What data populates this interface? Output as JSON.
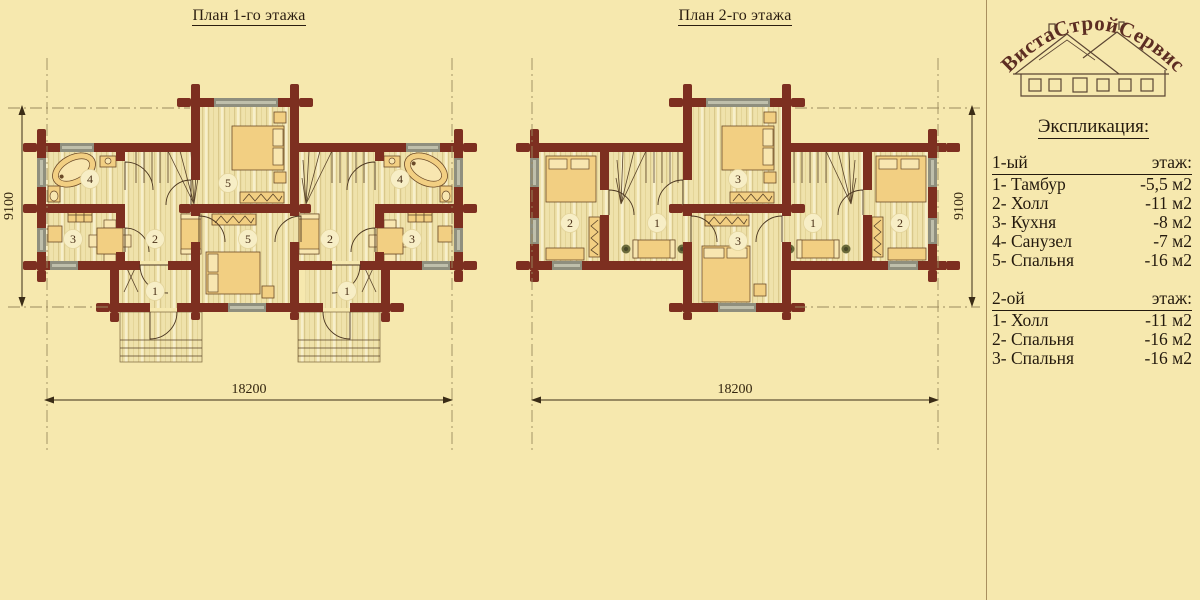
{
  "colors": {
    "background": "#f6e8ae",
    "wall": "#7d2f20",
    "floor": "#efe2ab",
    "furniture": "#f2cf82",
    "window_gray": "#8f8f7e",
    "text": "#2a1d10",
    "logo": "#5c2d22"
  },
  "plans": [
    {
      "title": "План 1-го этажа",
      "dim_width": "18200",
      "dim_height": "9100",
      "labels": [
        "4",
        "2",
        "3",
        "5",
        "1",
        "5",
        "2",
        "4",
        "3",
        "1"
      ]
    },
    {
      "title": "План 2-го этажа",
      "dim_width": "18200",
      "dim_height": "9100",
      "labels": [
        "2",
        "1",
        "3",
        "3",
        "1",
        "2"
      ]
    }
  ],
  "logo": {
    "text": "ВистаСтройСервис"
  },
  "legend": {
    "heading": "Экспликация:",
    "sections": [
      {
        "floor": "1-ый",
        "suffix": "этаж:",
        "rows": [
          {
            "name": "1- Тамбур",
            "area": "-5,5 м2"
          },
          {
            "name": "2- Холл",
            "area": "-11 м2"
          },
          {
            "name": "3- Кухня",
            "area": "-8 м2"
          },
          {
            "name": "4- Санузел",
            "area": "-7 м2"
          },
          {
            "name": "5- Спальня",
            "area": "-16 м2"
          }
        ]
      },
      {
        "floor": "2-ой",
        "suffix": "этаж:",
        "rows": [
          {
            "name": "1- Холл",
            "area": "-11 м2"
          },
          {
            "name": "2- Спальня",
            "area": "-16 м2"
          },
          {
            "name": "3- Спальня",
            "area": "-16 м2"
          }
        ]
      }
    ]
  }
}
